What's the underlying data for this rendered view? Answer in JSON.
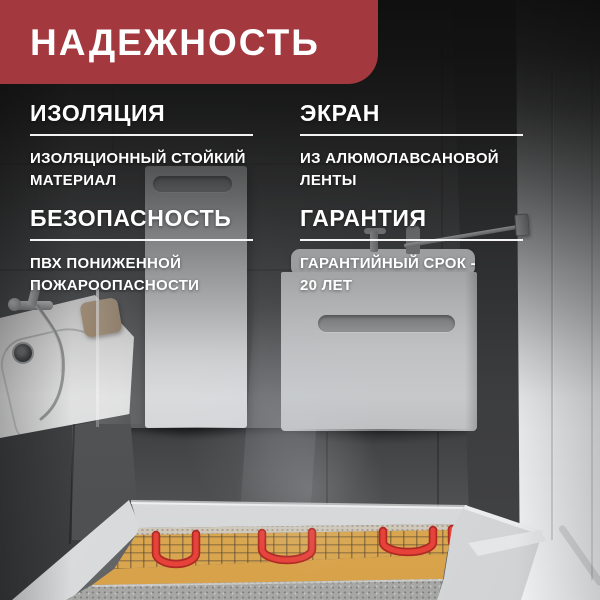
{
  "banner": {
    "title": "НАДЕЖНОСТЬ"
  },
  "features": [
    {
      "title": "ИЗОЛЯЦИЯ",
      "description": "ИЗОЛЯЦИОННЫЙ СТОЙКИЙ\nМАТЕРИАЛ"
    },
    {
      "title": "ЭКРАН",
      "description": "ИЗ АЛЮМОЛАВСАНОВОЙ\nЛЕНТЫ"
    },
    {
      "title": "БЕЗОПАСНОСТЬ",
      "description": "ПВХ ПОНИЖЕННОЙ\nПОЖАРООПАСНОСТИ"
    },
    {
      "title": "ГАРАНТИЯ",
      "description": "ГАРАНТИЙНЫЙ СРОК -\n20 ЛЕТ"
    }
  ],
  "colors": {
    "banner_red": "#A3383F",
    "text_white": "#FFFFFF",
    "mat_yellow": "#D9A64F",
    "cable_red": "#E6423A",
    "cable_red_dark": "#B02A24",
    "wall_dark": "#3C3D3F",
    "floor_light": "#ECEDED"
  },
  "scene": {
    "objects": [
      "bathtub",
      "shower-mixer",
      "tall-cabinet",
      "vanity-cabinet",
      "towel-rail",
      "shower-door",
      "tiled-walls",
      "heating-mat",
      "heating-cable"
    ]
  }
}
